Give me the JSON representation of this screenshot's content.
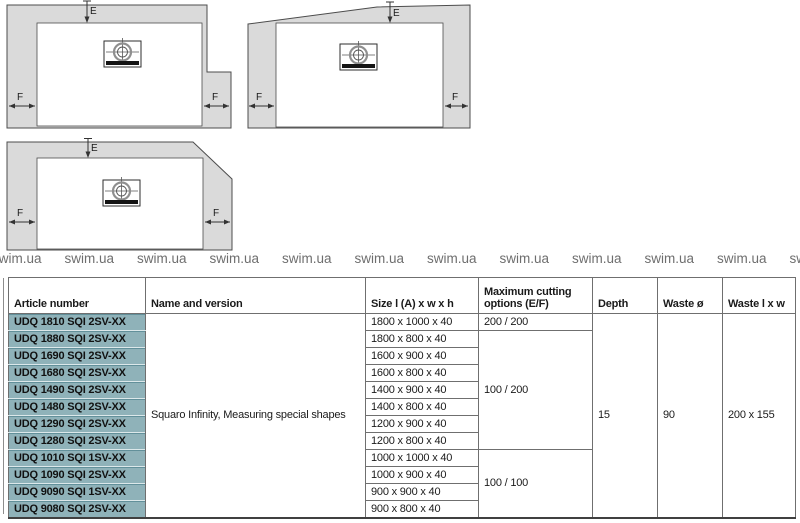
{
  "diagrams": {
    "label_e": "E",
    "label_f": "F"
  },
  "watermark": {
    "text": "swim.ua",
    "repeat": 12
  },
  "colors": {
    "article_bg": "#8fb2b9",
    "article_edge": "#62909a",
    "diagram_fill": "#dadada",
    "diagram_stroke": "#4c4c4c",
    "watermark_color": "#6e6e6e",
    "table_border": "#6f6f6f",
    "text_color": "#1a1a1a"
  },
  "table": {
    "headers": {
      "article": "Article number",
      "name": "Name and version",
      "size": "Size l (A) x w x h",
      "cutting": "Maximum cutting options (E/F)",
      "depth": "Depth",
      "waste_diameter": "Waste ø",
      "waste_l_x_w": "Waste l x w"
    },
    "merged": {
      "name_and_version": "Squaro Infinity, Measuring special shapes",
      "depth": "15",
      "waste_diameter": "90",
      "waste_l_x_w": "200 x 155"
    },
    "cutting_options": [
      {
        "value": "200 / 200",
        "row_span": 1
      },
      {
        "value": "100 / 200",
        "row_span": 7
      },
      {
        "value": "100 / 100",
        "row_span": 4
      }
    ],
    "rows": [
      {
        "article": "UDQ 1810 SQI 2SV-XX",
        "size": "1800 x 1000 x 40"
      },
      {
        "article": "UDQ 1880 SQI 2SV-XX",
        "size": "1800 x 800 x 40"
      },
      {
        "article": "UDQ 1690 SQI 2SV-XX",
        "size": "1600 x 900 x 40"
      },
      {
        "article": "UDQ 1680 SQI 2SV-XX",
        "size": "1600 x 800 x 40"
      },
      {
        "article": "UDQ 1490 SQI 2SV-XX",
        "size": "1400 x 900 x 40"
      },
      {
        "article": "UDQ 1480 SQI 2SV-XX",
        "size": "1400 x 800 x 40"
      },
      {
        "article": "UDQ 1290 SQI 2SV-XX",
        "size": "1200 x 900 x 40"
      },
      {
        "article": "UDQ 1280 SQI 2SV-XX",
        "size": "1200 x 800 x 40"
      },
      {
        "article": "UDQ 1010 SQI 1SV-XX",
        "size": "1000 x 1000 x 40"
      },
      {
        "article": "UDQ 1090 SQI 2SV-XX",
        "size": "1000 x 900 x 40"
      },
      {
        "article": "UDQ 9090 SQI 1SV-XX",
        "size": "900 x 900 x 40"
      },
      {
        "article": "UDQ 9080 SQI 2SV-XX",
        "size": "900 x 800 x 40"
      }
    ]
  }
}
